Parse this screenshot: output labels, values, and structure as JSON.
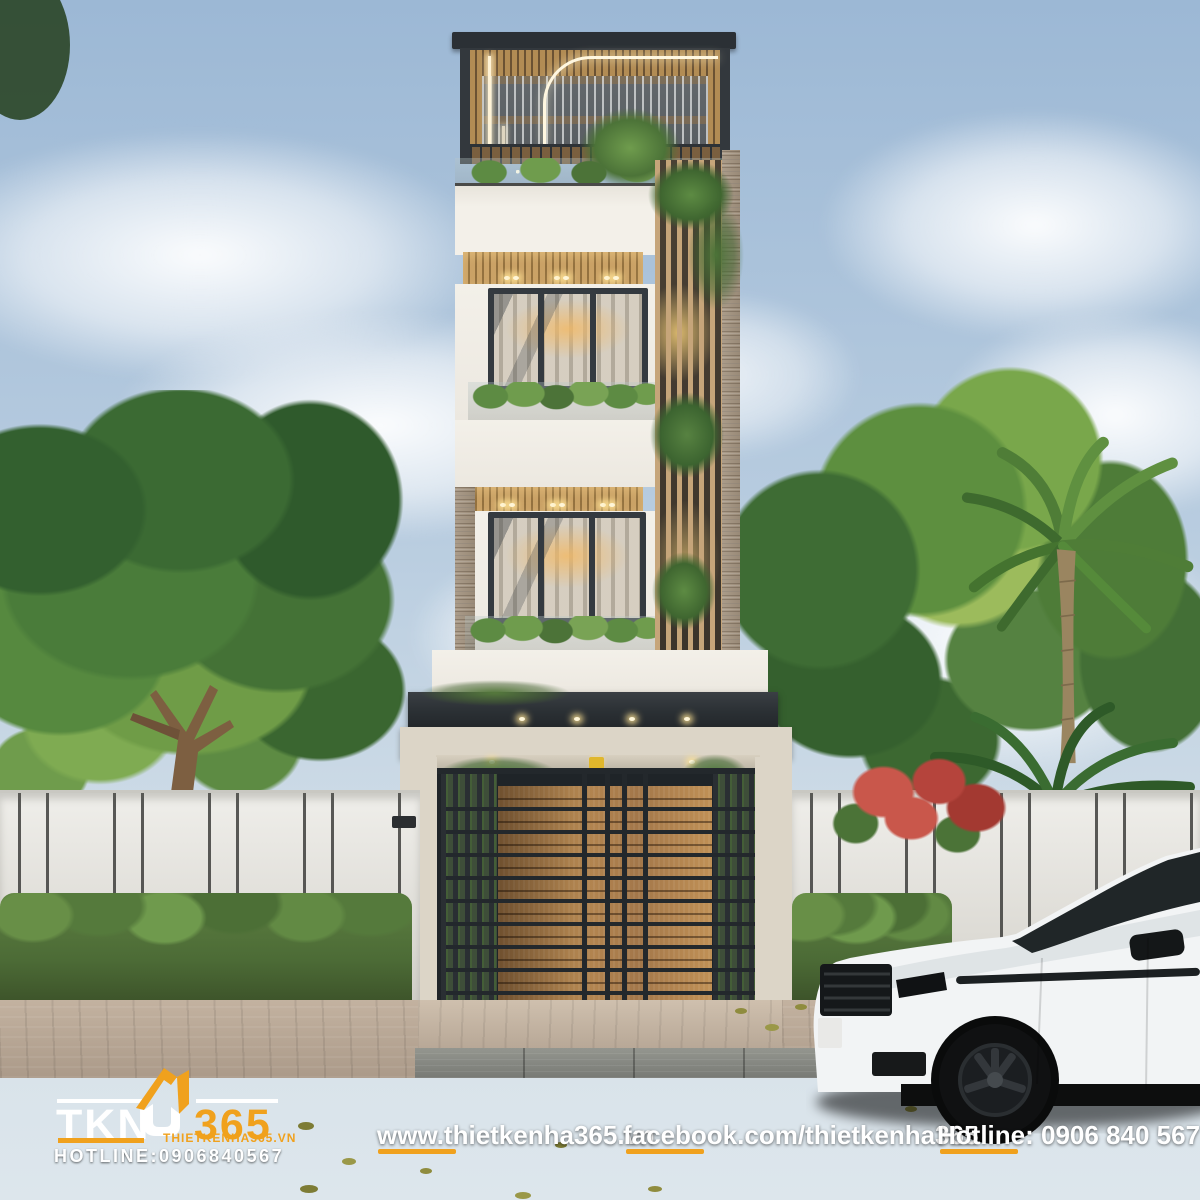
{
  "branding": {
    "logo_text_tkn": "TKN",
    "logo_text_365": "365",
    "logo_domain": "THIETKENHA365.VN",
    "logo_hotline": "HOTLINE:0906840567"
  },
  "footer": {
    "website": "www.thietkenha365.vn",
    "facebook": "facebook.com/thietkenha365",
    "hotline": "Hotline: 0906 840 567"
  },
  "colors": {
    "accent_orange": "#F0A11D",
    "logo_white": "#FFFFFF",
    "sky_top": "#9CB8D5",
    "sky_horizon": "#D3DFE8",
    "foliage_dark": "#33602F",
    "foliage_bright": "#9CBB5C",
    "facade_white": "#F2EFE8",
    "roof_charcoal": "#2B3035",
    "wood_slat": "#B28C54",
    "brick_pier": "#A3947F",
    "stone_beam": "#DCD5C7",
    "gate_wood": "#A87C4B",
    "metal_dark": "#23282C",
    "fence_wall": "#E7E5E0",
    "hedge_green": "#55763E",
    "sidewalk_paver": "#B7A695",
    "road_asphalt": "#2A2B2B",
    "car_white": "#F2F4F5"
  }
}
